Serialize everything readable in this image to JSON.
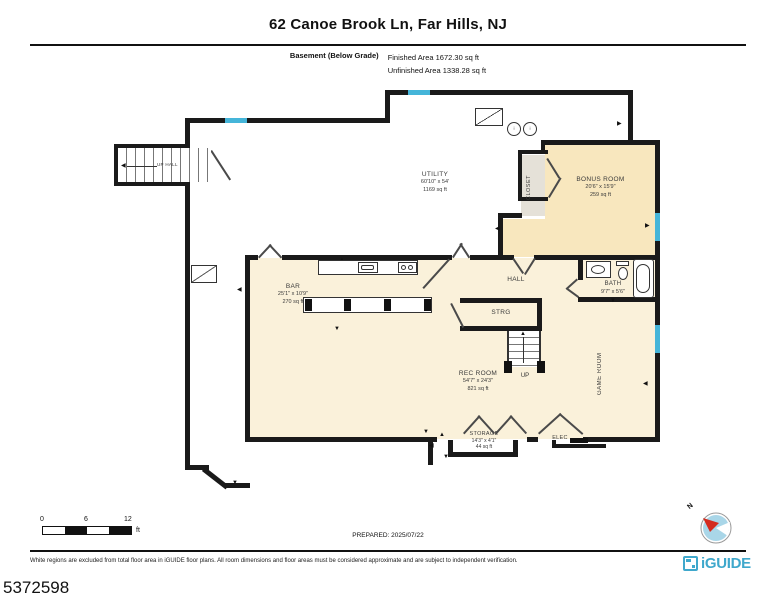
{
  "header": {
    "title": "62 Canoe Brook Ln, Far Hills, NJ",
    "floor_label": "Basement (Below Grade)",
    "finished_area": "Finished Area 1672.30 sq ft",
    "unfinished_area": "Unfinished Area 1338.28 sq ft"
  },
  "rooms": [
    {
      "name": "UTILITY",
      "dims": "60'10\" x 54'",
      "area": "1169 sq ft"
    },
    {
      "name": "BONUS ROOM",
      "dims": "20'6\" x 15'9\"",
      "area": "259 sq ft"
    },
    {
      "name": "CLOSET"
    },
    {
      "name": "BAR",
      "dims": "25'1\" x 10'9\"",
      "area": "270 sq ft"
    },
    {
      "name": "HALL"
    },
    {
      "name": "BATH",
      "dims": "9'7\" x 5'6\""
    },
    {
      "name": "STRG"
    },
    {
      "name": "REC ROOM",
      "dims": "54'7\" x 24'3\"",
      "area": "821 sq ft"
    },
    {
      "name": "GAME ROOM"
    },
    {
      "name": "STORAGE",
      "dims": "14'3\" x 4'1\"",
      "area": "44 sq ft"
    },
    {
      "name": "ELEC"
    }
  ],
  "stairs": {
    "upper_label": "UP HALL",
    "lower_label": "UP"
  },
  "scale_bar": {
    "tick0": "0",
    "tick1": "6",
    "tick2": "12",
    "unit": "ft"
  },
  "compass": {
    "north": "N"
  },
  "footer": {
    "prepared": "PREPARED: 2025/07/22",
    "disclaimer": "White regions are excluded from total floor area in iGUIDE floor plans. All room dimensions and floor areas must be considered approximate and are subject to independent verification.",
    "brand": "iGUIDE",
    "photo_id": "5372598"
  },
  "colors": {
    "finished": "#FAF1DA",
    "bonus": "#F8E7BE",
    "bar": "#E2EDE5",
    "bath": "#BDE2F2",
    "closet": "#E5E1D8",
    "strg": "#E8E2DB",
    "window": "#45B5D9",
    "wall": "#1A1A1A",
    "brand": "#3FA8CC",
    "compass_red": "#D42B1E",
    "compass_blue": "#A9D6E8"
  }
}
